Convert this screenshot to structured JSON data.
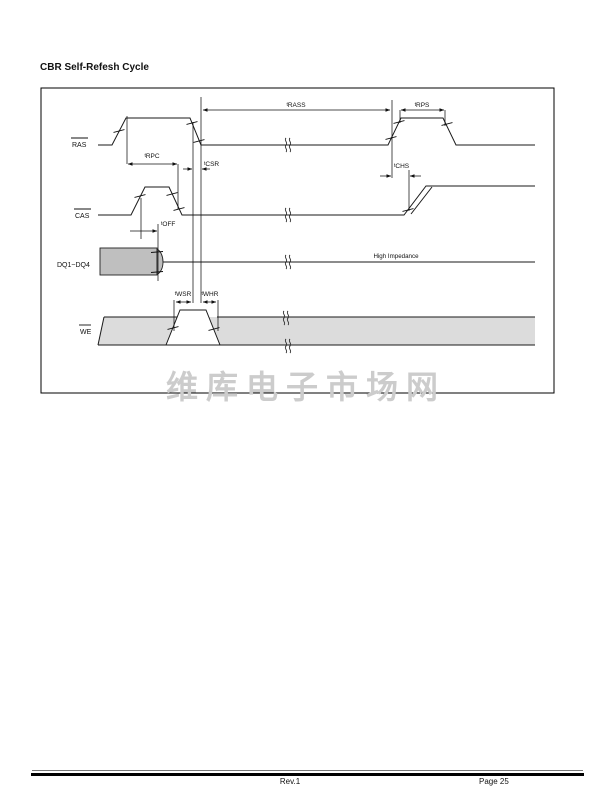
{
  "page": {
    "title": "CBR Self-Refesh Cycle",
    "watermark": "维库电子市场网",
    "footer": {
      "revision": "Rev.1",
      "page": "Page 25"
    }
  },
  "diagram": {
    "signals": {
      "ras": "RAS",
      "cas": "CAS",
      "dq": "DQ1~DQ4",
      "we": "WE"
    },
    "timing_labels": {
      "trass": "tRASS",
      "trps": "tRPS",
      "trpc": "tRPC",
      "tcsr": "tCSR",
      "tchs": "tCHS",
      "toff": "tOFF",
      "twsr": "tWSR",
      "twhr": "tWHR"
    },
    "annotations": {
      "high_impedance": "High Impedance"
    },
    "colors": {
      "line": "#1a1a1a",
      "dq_fill": "#bfbfbf",
      "we_band_fill": "#dcdcdc",
      "watermark": "#cccccc"
    }
  }
}
